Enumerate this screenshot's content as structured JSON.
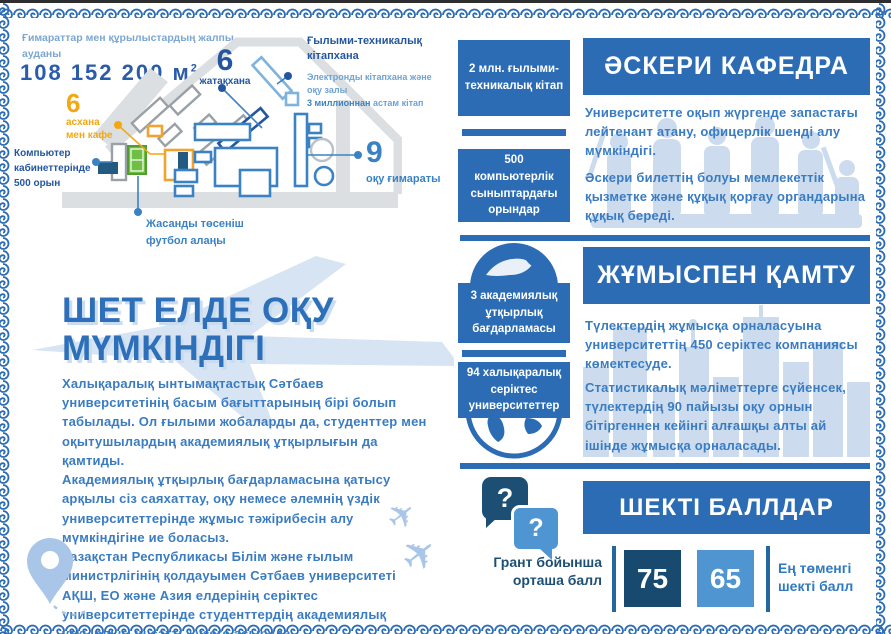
{
  "colors": {
    "primary": "#2b6cb5",
    "navy": "#2456a0",
    "dark_navy": "#174a6e",
    "light_blue": "#4e95d2",
    "accent_yellow": "#f3a712",
    "field_green": "#6fbf44"
  },
  "campus": {
    "area_label": "Ғимараттар мен құрылыстардың жалпы ауданы",
    "area_value": "108 152 200 м",
    "area_sup": "2",
    "dorm_number": "6",
    "dorm_label": "жатақхана",
    "library_title": "Ғылыми-техникалық кітапхана",
    "library_line1": "Электронды кітапхана және оқу залы",
    "library_line2_bold": "3 миллионнан",
    "library_line2_rest": " астам кітап",
    "canteen_number": "6",
    "canteen_label": "асхана мен кафе",
    "computer_label": "Компьютер кабинеттерінде 500 орын",
    "football_label": "Жасанды төсеніш футбол алаңы",
    "study_number": "9",
    "study_label": "оқу ғимараты"
  },
  "study_abroad": {
    "title_line1": "ШЕТ ЕЛДЕ ОҚУ",
    "title_line2": "МҮМКІНДІГІ",
    "paragraphs": [
      "Халықаралық ынтымақтастық Сәтбаев университетінің басым бағыттарының бірі болып табылады. Ол ғылыми жобаларды да, студенттер мен оқытушылардың академиялық ұтқырлығын да қамтиды.",
      "Академиялық ұтқырлық бағдарламасына қатысу арқылы сіз саяхаттау, оқу немесе әлемнің үздік университеттерінде жұмыс тәжірибесін алу мүмкіндігіне ие боласыз.",
      "Қазақстан Республикасы Білім және ғылым министрлігінің қолдауымен Сәтбаев университеті АҚШ, ЕО және Азия елдерінің серіктес университеттерінде студенттердің академиялық ұтқырлығын сәтті жүзеге асыруда."
    ]
  },
  "stats": {
    "books": "2 млн. ғылыми-техникалық кітап",
    "computers": "500 компьютерлік сыныптардағы орындар",
    "mobility": "3 академиялық ұтқырлық бағдарламасы",
    "partners": "94 халықаралық серіктес университеттер"
  },
  "military": {
    "title": "ӘСКЕРИ КАФЕДРА",
    "p1": "Университетте оқып жүргенде запастағы лейтенант атану, офицерлік шенді алу мүмкіндігі.",
    "p2": "Әскери билеттің болуы мемлекеттік қызметке және құқық қорғау органдарына құқық береді."
  },
  "employment": {
    "title": "ЖҰМЫСПЕН ҚАМТУ",
    "p1": "Түлектердің жұмысқа орналасуына университеттің 450 серіктес компаниясы көмектесуде.",
    "p2": "Статистикалық мәліметтерге сүйенсек, түлектердің 90 пайызы оқу орнын бітіргеннен кейінгі алғашқы алты ай ішінде жұмысқа орналасады."
  },
  "threshold": {
    "title": "ШЕКТІ БАЛЛДАР",
    "question_mark": "?",
    "grant_label": "Грант бойынша орташа балл",
    "grant_score": "75",
    "min_score": "65",
    "min_label": "Ең төменгі шекті балл"
  }
}
